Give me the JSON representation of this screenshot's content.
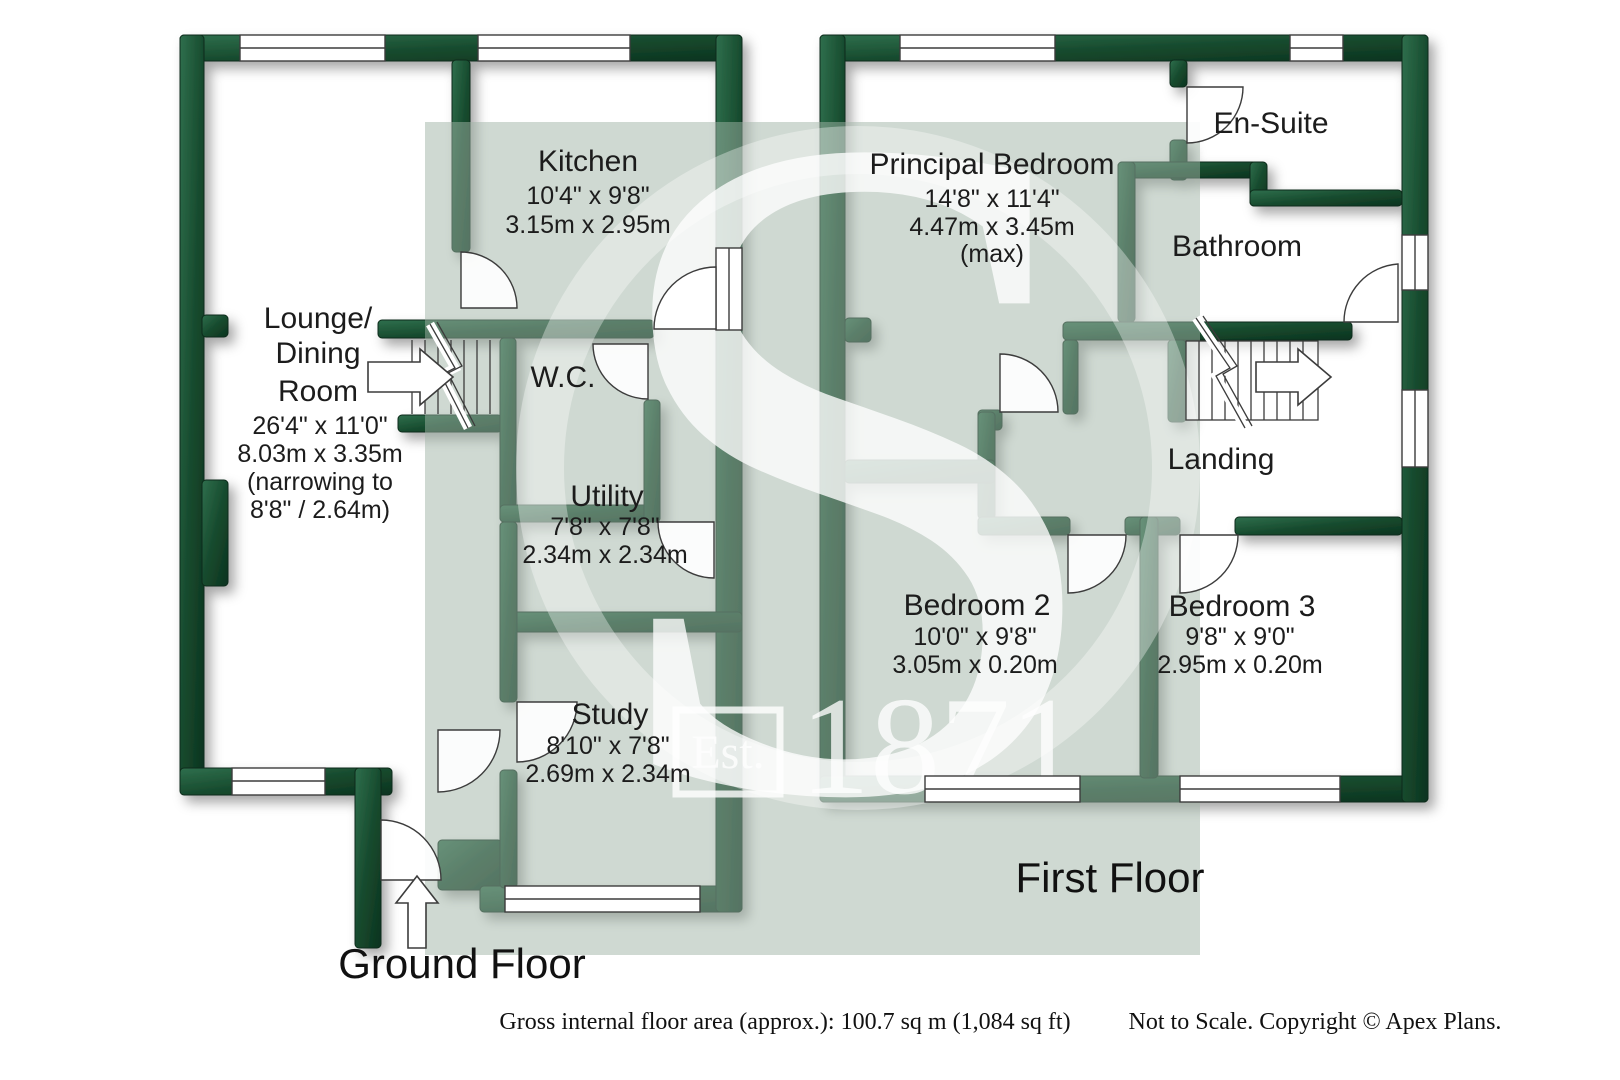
{
  "watermark": {
    "letter": "S",
    "est": "Est.",
    "year": "1871"
  },
  "floor_titles": {
    "ground": "Ground Floor",
    "first": "First Floor"
  },
  "labels": {
    "lounge": {
      "name1": "Lounge/",
      "name2": "Dining",
      "name3": "Room",
      "dim_ft": "26'4\" x 11'0\"",
      "dim_m": "8.03m x 3.35m",
      "note1": "(narrowing to",
      "note2": "8'8\" / 2.64m)"
    },
    "kitchen": {
      "name": "Kitchen",
      "dim_ft": "10'4\" x 9'8\"",
      "dim_m": "3.15m x 2.95m"
    },
    "wc": {
      "name": "W.C."
    },
    "utility": {
      "name": "Utility",
      "dim_ft": "7'8\" x 7'8\"",
      "dim_m": "2.34m x 2.34m"
    },
    "study": {
      "name": "Study",
      "dim_ft": "8'10\" x 7'8\"",
      "dim_m": "2.69m x 2.34m"
    },
    "principal": {
      "name": "Principal Bedroom",
      "dim_ft": "14'8\" x 11'4\"",
      "dim_m": "4.47m x 3.45m",
      "note": "(max)"
    },
    "ensuite": {
      "name": "En-Suite"
    },
    "bathroom": {
      "name": "Bathroom"
    },
    "landing": {
      "name": "Landing"
    },
    "bed2": {
      "name": "Bedroom 2",
      "dim_ft": "10'0\" x 9'8\"",
      "dim_m": "3.05m x 0.20m"
    },
    "bed3": {
      "name": "Bedroom 3",
      "dim_ft": "9'8\" x 9'0\"",
      "dim_m": "2.95m x 0.20m"
    }
  },
  "footer": {
    "area": "Gross internal floor area (approx.): 100.7 sq m (1,084 sq ft)",
    "note": "Not to Scale. Copyright © Apex Plans."
  },
  "colors": {
    "wall": "#174b2e",
    "tint": "#cdd8d1",
    "line": "#3c3c3c"
  }
}
